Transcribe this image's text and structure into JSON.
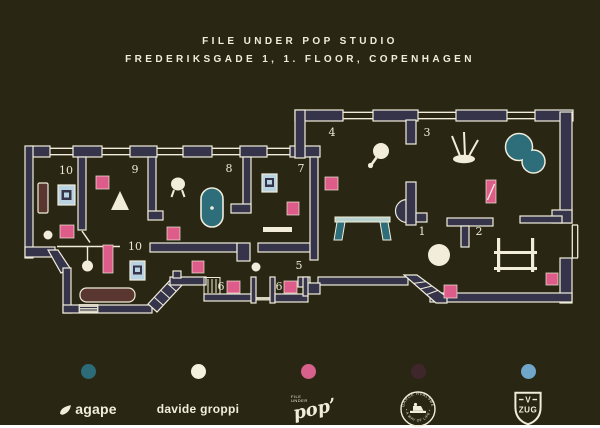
{
  "title": {
    "line1": "FILE UNDER POP STUDIO",
    "line2": "FREDERIKSGADE 1, 1. FLOOR, COPENHAGEN"
  },
  "colors": {
    "background": "#292713",
    "wall": "#35344a",
    "cream": "#f1edda",
    "pink": "#dd5c89",
    "teal": "#2e6e7a",
    "light_blue": "#b9d3e2",
    "brown": "#59362f"
  },
  "plan": {
    "room_labels": [
      {
        "text": "10",
        "x": 66,
        "y": 174
      },
      {
        "text": "9",
        "x": 135,
        "y": 173
      },
      {
        "text": "8",
        "x": 229,
        "y": 172
      },
      {
        "text": "7",
        "x": 301,
        "y": 172
      },
      {
        "text": "4",
        "x": 332,
        "y": 136
      },
      {
        "text": "3",
        "x": 427,
        "y": 136
      },
      {
        "text": "1",
        "x": 422,
        "y": 235
      },
      {
        "text": "2",
        "x": 479,
        "y": 235
      },
      {
        "text": "5",
        "x": 299,
        "y": 269
      },
      {
        "text": "6",
        "x": 221,
        "y": 290
      },
      {
        "text": "6",
        "x": 279,
        "y": 290
      },
      {
        "text": "10",
        "x": 135,
        "y": 250
      }
    ],
    "furniture": [
      {
        "name": "pink-cabinet-room9",
        "shapes": [
          {
            "t": "rect",
            "x": 96,
            "y": 176,
            "width": 13,
            "height": 13,
            "fill": "#dd5c89",
            "stroke": "rgba(241,237,218,0.75)",
            "stroke-width": 0.9
          }
        ]
      },
      {
        "name": "pink-cabinet-room10-left",
        "shapes": [
          {
            "t": "rect",
            "x": 60,
            "y": 225,
            "width": 14,
            "height": 13,
            "fill": "#dd5c89",
            "stroke": "rgba(241,237,218,0.75)",
            "stroke-width": 0.9
          }
        ]
      },
      {
        "name": "pink-cabinet-room7",
        "shapes": [
          {
            "t": "rect",
            "x": 287,
            "y": 202,
            "width": 12,
            "height": 13,
            "fill": "#dd5c89",
            "stroke": "rgba(241,237,218,0.75)",
            "stroke-width": 0.9
          }
        ]
      },
      {
        "name": "pink-cabinet-room4",
        "shapes": [
          {
            "t": "rect",
            "x": 325,
            "y": 177,
            "width": 13,
            "height": 13,
            "fill": "#dd5c89",
            "stroke": "rgba(241,237,218,0.75)",
            "stroke-width": 0.9
          }
        ]
      },
      {
        "name": "pink-cabinet-room8",
        "shapes": [
          {
            "t": "rect",
            "x": 167,
            "y": 227,
            "width": 13,
            "height": 13,
            "fill": "#dd5c89",
            "stroke": "rgba(241,237,218,0.75)",
            "stroke-width": 0.9
          }
        ]
      },
      {
        "name": "pink-cabinet-room1",
        "shapes": [
          {
            "t": "rect",
            "x": 444,
            "y": 285,
            "width": 13,
            "height": 13,
            "fill": "#dd5c89",
            "stroke": "rgba(241,237,218,0.75)",
            "stroke-width": 0.9
          }
        ]
      },
      {
        "name": "pink-cabinet-room2",
        "shapes": [
          {
            "t": "rect",
            "x": 546,
            "y": 273,
            "width": 12,
            "height": 12,
            "fill": "#dd5c89",
            "stroke": "rgba(241,237,218,0.75)",
            "stroke-width": 0.9
          }
        ]
      },
      {
        "name": "pink-cabinet-room6a",
        "shapes": [
          {
            "t": "rect",
            "x": 227,
            "y": 281,
            "width": 13,
            "height": 12,
            "fill": "#dd5c89",
            "stroke": "rgba(241,237,218,0.75)",
            "stroke-width": 0.9
          }
        ]
      },
      {
        "name": "pink-cabinet-room6b",
        "shapes": [
          {
            "t": "rect",
            "x": 284,
            "y": 281,
            "width": 13,
            "height": 12,
            "fill": "#dd5c89",
            "stroke": "rgba(241,237,218,0.75)",
            "stroke-width": 0.9
          }
        ]
      },
      {
        "name": "pink-cabinet-hall",
        "shapes": [
          {
            "t": "rect",
            "x": 192,
            "y": 261,
            "width": 12,
            "height": 12,
            "fill": "#dd5c89",
            "stroke": "rgba(241,237,218,0.75)",
            "stroke-width": 0.9
          }
        ]
      },
      {
        "name": "pink-sideboard-room10-bottom",
        "shapes": [
          {
            "t": "rect",
            "x": 103,
            "y": 245,
            "width": 10,
            "height": 28,
            "fill": "#dd5c89",
            "stroke": "rgba(241,237,218,0.75)",
            "stroke-width": 0.9
          }
        ]
      },
      {
        "name": "pink-mirror-room3",
        "shapes": [
          {
            "t": "rect",
            "x": 486,
            "y": 180,
            "width": 10,
            "height": 23,
            "fill": "#dd5c89",
            "stroke": "rgba(241,237,218,0.75)",
            "stroke-width": 0.9
          },
          {
            "t": "line",
            "x1": 487.5,
            "y1": 200,
            "x2": 494.5,
            "y2": 184,
            "stroke": "#f1edda",
            "stroke-width": 1.4
          }
        ]
      },
      {
        "name": "blue-stove-room10-left",
        "shapes": [
          {
            "t": "rect",
            "x": 58,
            "y": 185,
            "width": 17,
            "height": 20,
            "fill": "#b9d3e2",
            "stroke": "#f1edda",
            "stroke-width": 1.2
          },
          {
            "t": "rect",
            "x": 61.5,
            "y": 190,
            "width": 10,
            "height": 10,
            "fill": "#35344a"
          },
          {
            "t": "rect",
            "x": 64,
            "y": 192.5,
            "width": 5,
            "height": 5,
            "fill": "#b9d3e2"
          }
        ]
      },
      {
        "name": "blue-artwork-room7",
        "shapes": [
          {
            "t": "rect",
            "x": 262,
            "y": 174,
            "width": 15,
            "height": 18,
            "fill": "#b9d3e2",
            "stroke": "#f1edda",
            "stroke-width": 1.2
          },
          {
            "t": "rect",
            "x": 265,
            "y": 178,
            "width": 9,
            "height": 9,
            "fill": "#35344a"
          },
          {
            "t": "rect",
            "x": 267,
            "y": 180,
            "width": 5,
            "height": 4.5,
            "fill": "#b9d3e2"
          }
        ]
      },
      {
        "name": "blue-stove-room10-bottom",
        "shapes": [
          {
            "t": "rect",
            "x": 130,
            "y": 261,
            "width": 15,
            "height": 19,
            "fill": "#b9d3e2",
            "stroke": "#f1edda",
            "stroke-width": 1.2
          },
          {
            "t": "rect",
            "x": 133,
            "y": 265.5,
            "width": 9,
            "height": 9,
            "fill": "#35344a"
          },
          {
            "t": "rect",
            "x": 135,
            "y": 267.5,
            "width": 5,
            "height": 4.5,
            "fill": "#b9d3e2"
          }
        ]
      },
      {
        "name": "brown-bench-room10-left",
        "shapes": [
          {
            "t": "rect",
            "x": 38,
            "y": 183,
            "width": 10,
            "height": 30,
            "rx": 1.5,
            "fill": "#59362f",
            "stroke": "#f1edda",
            "stroke-width": 1.2
          }
        ]
      },
      {
        "name": "brown-sofa-room10-bottom",
        "shapes": [
          {
            "t": "rect",
            "x": 80,
            "y": 288,
            "width": 55,
            "height": 14,
            "rx": 6.5,
            "fill": "#59362f",
            "stroke": "#f1edda",
            "stroke-width": 1.2
          }
        ]
      },
      {
        "name": "bathtub-room8",
        "shapes": [
          {
            "t": "rect",
            "x": 201,
            "y": 188,
            "width": 22,
            "height": 39,
            "rx": 11,
            "fill": "#2e6e7a",
            "stroke": "#f1edda",
            "stroke-width": 1.6
          },
          {
            "t": "circle",
            "cx": 212,
            "cy": 208,
            "r": 1.8,
            "fill": "#f1edda"
          }
        ]
      },
      {
        "name": "pool-room3",
        "shapes": [
          {
            "t": "circle",
            "cx": 519,
            "cy": 147,
            "r": 13.5,
            "fill": "#2e6e7a",
            "stroke": "#f1edda",
            "stroke-width": 1.5
          },
          {
            "t": "circle",
            "cx": 533.5,
            "cy": 161.5,
            "r": 11.5,
            "fill": "#2e6e7a",
            "stroke": "#f1edda",
            "stroke-width": 1.5
          },
          {
            "t": "circle",
            "cx": 519,
            "cy": 147,
            "r": 12.6,
            "fill": "#2e6e7a"
          },
          {
            "t": "circle",
            "cx": 533.5,
            "cy": 161.5,
            "r": 10.6,
            "fill": "#2e6e7a"
          }
        ]
      },
      {
        "name": "table-room4",
        "shapes": [
          {
            "t": "rect",
            "x": 335,
            "y": 217,
            "width": 55,
            "height": 5,
            "fill": "#b7d2cf",
            "stroke": "#f1edda",
            "stroke-width": 1
          },
          {
            "t": "polygon",
            "points": "337,222 345,222 342,240 334,240",
            "fill": "#2e6e7a",
            "stroke": "#f1edda",
            "stroke-width": 1
          },
          {
            "t": "polygon",
            "points": "380,222 388,222 391,240 383,240",
            "fill": "#2e6e7a",
            "stroke": "#f1edda",
            "stroke-width": 1
          }
        ]
      },
      {
        "name": "cone-lamp-room9",
        "shapes": [
          {
            "t": "polygon",
            "points": "120,191 129,210 111,210",
            "fill": "#f1edda"
          }
        ]
      },
      {
        "name": "lamp-room8",
        "shapes": [
          {
            "t": "ellipse",
            "cx": 178,
            "cy": 184,
            "rx": 7,
            "ry": 6.5,
            "fill": "#f1edda"
          },
          {
            "t": "line",
            "x1": 174,
            "y1": 190,
            "x2": 171.5,
            "y2": 197,
            "stroke": "#f1edda",
            "stroke-width": 2
          },
          {
            "t": "line",
            "x1": 182,
            "y1": 190,
            "x2": 184.5,
            "y2": 197,
            "stroke": "#f1edda",
            "stroke-width": 2
          }
        ]
      },
      {
        "name": "balloon-lamp-room10-bottom",
        "shapes": [
          {
            "t": "line",
            "x1": 87.5,
            "y1": 247,
            "x2": 87.5,
            "y2": 261,
            "stroke": "#f1edda",
            "stroke-width": 1.4
          },
          {
            "t": "circle",
            "cx": 87.5,
            "cy": 266,
            "r": 5.5,
            "fill": "#f1edda"
          }
        ]
      },
      {
        "name": "mirror-room4",
        "shapes": [
          {
            "t": "circle",
            "cx": 381,
            "cy": 151,
            "r": 8,
            "fill": "#f1edda"
          },
          {
            "t": "line",
            "x1": 376.5,
            "y1": 157.5,
            "x2": 371.5,
            "y2": 164.5,
            "stroke": "#f1edda",
            "stroke-width": 2.6
          },
          {
            "t": "circle",
            "cx": 370.5,
            "cy": 165.5,
            "r": 2.6,
            "fill": "#f1edda"
          }
        ]
      },
      {
        "name": "sculpture-room3",
        "shapes": [
          {
            "t": "line",
            "x1": 460,
            "y1": 156,
            "x2": 452,
            "y2": 136,
            "stroke": "#f1edda",
            "stroke-width": 2
          },
          {
            "t": "line",
            "x1": 465,
            "y1": 156,
            "x2": 464,
            "y2": 132,
            "stroke": "#f1edda",
            "stroke-width": 2
          },
          {
            "t": "line",
            "x1": 469,
            "y1": 156,
            "x2": 478,
            "y2": 140,
            "stroke": "#f1edda",
            "stroke-width": 2
          },
          {
            "t": "ellipse",
            "cx": 464,
            "cy": 159,
            "rx": 11,
            "ry": 4.2,
            "fill": "#f1edda"
          }
        ]
      },
      {
        "name": "shelf-room7",
        "shapes": [
          {
            "t": "rect",
            "x": 263,
            "y": 227,
            "width": 29,
            "height": 5,
            "fill": "#f1edda"
          }
        ]
      },
      {
        "name": "dot-hall",
        "shapes": [
          {
            "t": "circle",
            "cx": 256,
            "cy": 267,
            "r": 4.5,
            "fill": "#f1edda"
          }
        ]
      },
      {
        "name": "ball-lamp-room1",
        "shapes": [
          {
            "t": "circle",
            "cx": 439,
            "cy": 255,
            "r": 11,
            "fill": "#f1edda"
          }
        ]
      },
      {
        "name": "dot-room10-left",
        "shapes": [
          {
            "t": "circle",
            "cx": 48,
            "cy": 235,
            "r": 4.5,
            "fill": "#f1edda"
          }
        ]
      },
      {
        "name": "table-room2",
        "shapes": [
          {
            "t": "rect",
            "x": 497,
            "y": 238,
            "width": 3.2,
            "height": 34,
            "fill": "#f1edda"
          },
          {
            "t": "rect",
            "x": 531,
            "y": 238,
            "width": 3.2,
            "height": 34,
            "fill": "#f1edda"
          },
          {
            "t": "rect",
            "x": 494,
            "y": 251,
            "width": 43,
            "height": 3,
            "fill": "#f1edda"
          },
          {
            "t": "rect",
            "x": 494,
            "y": 267,
            "width": 43,
            "height": 3,
            "fill": "#f1edda"
          }
        ]
      }
    ]
  },
  "legend": [
    {
      "brand": "agape",
      "color": "#2c6b78"
    },
    {
      "brand": "davide groppi",
      "color": "#f5f1df"
    },
    {
      "brand": "file under pop",
      "color": "#d7608c"
    },
    {
      "brand": "garde hvalsøe",
      "color": "#3f262a"
    },
    {
      "brand": "v-zug",
      "color": "#6fa6c9"
    }
  ],
  "brands": {
    "agape": {
      "label": "agape"
    },
    "davide_groppi": {
      "label": "davide groppi"
    },
    "pop": {
      "label": "pop’",
      "sub1": "FILE",
      "sub2": "UNDER"
    },
    "garde": {
      "ring_top": "GARDE HVALSØE",
      "ring_bottom": "• A WAY OF LIFE •"
    },
    "vzug": {
      "v": "V",
      "zug": "ZUG"
    }
  }
}
